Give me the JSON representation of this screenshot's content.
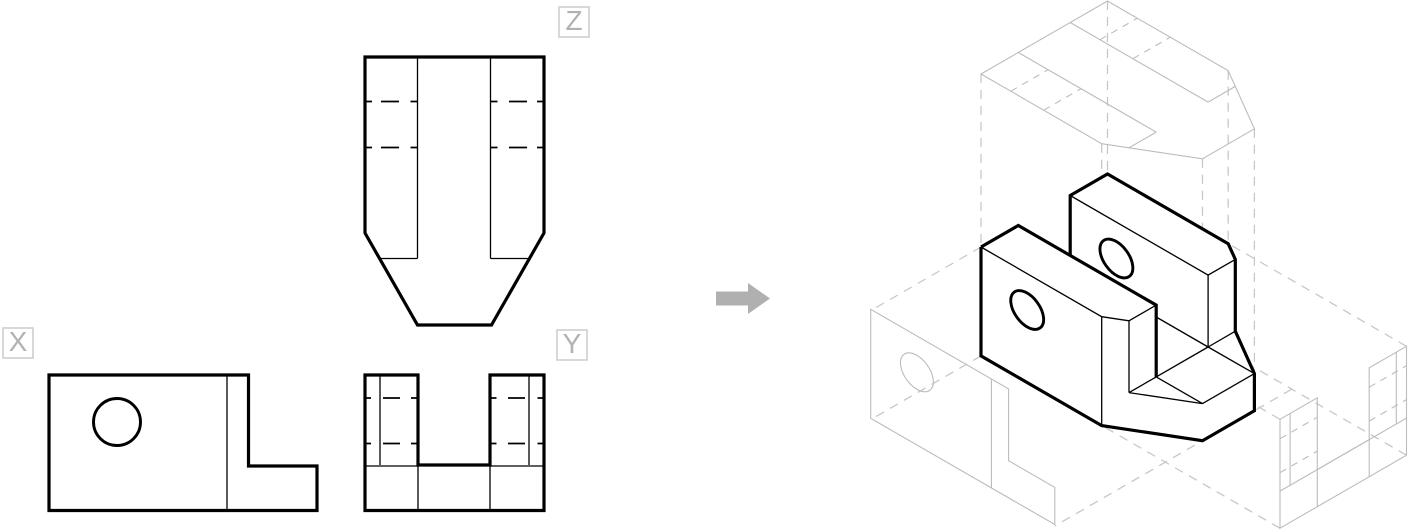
{
  "labels": {
    "front_view": "X",
    "side_view": "Y",
    "top_view": "Z"
  },
  "icons": {
    "transform_arrow": "right-arrow"
  },
  "colors": {
    "background": "#ffffff",
    "line_black": "#000000",
    "gray_line": "#bcbcbc",
    "gray_dash": "#c6c6c6",
    "arrow_gray": "#b0b0b0",
    "label_border": "#cfcfcf",
    "label_text": "#b2b2b2"
  }
}
